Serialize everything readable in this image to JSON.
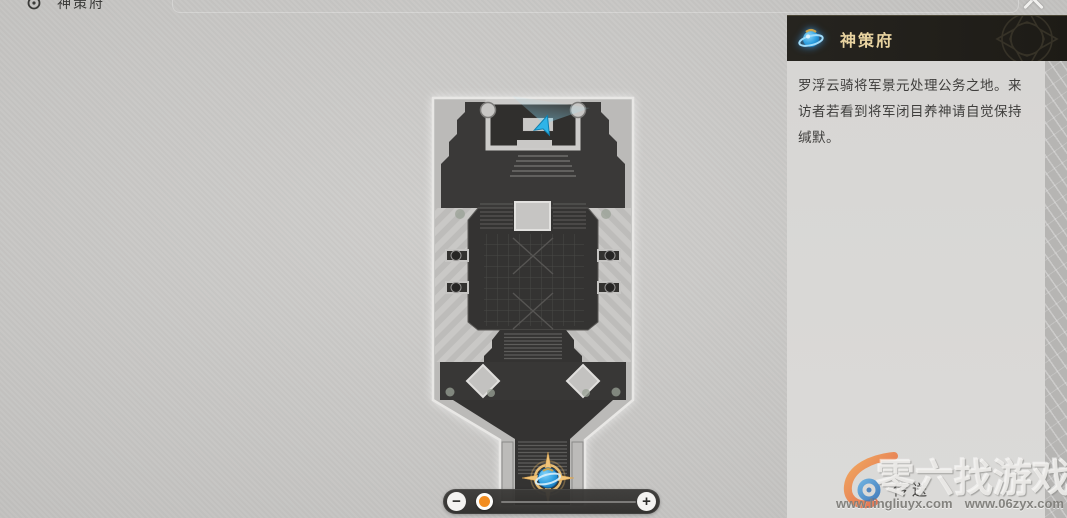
{
  "breadcrumb": {
    "label": "神策府",
    "icon": "location-ring-icon"
  },
  "close_button": {
    "icon": "x-close-icon"
  },
  "map": {
    "name": "神策府",
    "markers": {
      "player": "player-arrow",
      "teleport_anchor": "space-anchor-selected"
    }
  },
  "zoom_control": {
    "zoom_out_label": "−",
    "zoom_in_label": "+",
    "handle_fraction": 0.2
  },
  "panel": {
    "header": {
      "title": "神策府",
      "icon": "space-anchor-icon"
    },
    "description": "罗浮云骑将军景元处理公务之地。来访者若看到将军闭目养神请自觉保持缄默。",
    "teleport_label": "传送"
  },
  "watermark": {
    "site_name": "零六找游戏",
    "urls": [
      "www.lingliuyx.com",
      "www.06zyx.com"
    ]
  },
  "colors": {
    "accent_orange": "#f28d20",
    "anchor_blue": "#2d9fe0",
    "header_gold": "#e8d3a0",
    "header_bg": "#23211c",
    "map_dark": "#353432",
    "background": "#c9c8c6"
  }
}
